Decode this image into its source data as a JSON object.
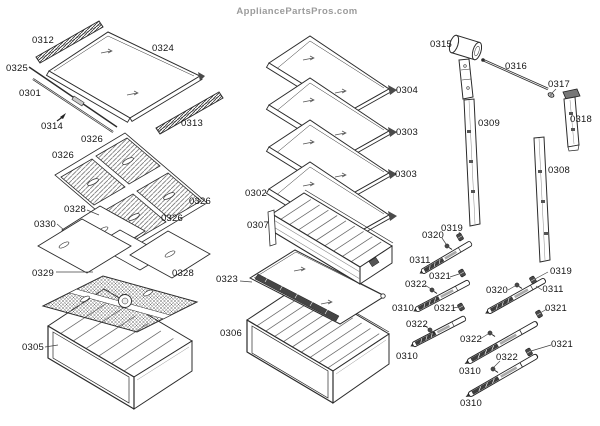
{
  "watermark": {
    "text": "AppliancePartsPros.com"
  },
  "colors": {
    "ink": "#2b2b2b",
    "label": "#141414",
    "watermark": "#9b9b9b",
    "background": "#ffffff"
  },
  "diagram": {
    "callouts": [
      {
        "part": "0312",
        "x": 43,
        "y": 43
      },
      {
        "part": "0324",
        "x": 163,
        "y": 51
      },
      {
        "part": "0325",
        "x": 17,
        "y": 71
      },
      {
        "part": "0301",
        "x": 30,
        "y": 96
      },
      {
        "part": "0314",
        "x": 52,
        "y": 129
      },
      {
        "part": "0313",
        "x": 192,
        "y": 126
      },
      {
        "part": "0326",
        "x": 92,
        "y": 142
      },
      {
        "part": "0326",
        "x": 63,
        "y": 158
      },
      {
        "part": "0326",
        "x": 200,
        "y": 204
      },
      {
        "part": "0326",
        "x": 172,
        "y": 221
      },
      {
        "part": "0328",
        "x": 75,
        "y": 212
      },
      {
        "part": "0330",
        "x": 45,
        "y": 227
      },
      {
        "part": "0329",
        "x": 43,
        "y": 276
      },
      {
        "part": "0328",
        "x": 183,
        "y": 276
      },
      {
        "part": "0305",
        "x": 33,
        "y": 350
      },
      {
        "part": "0304",
        "x": 407,
        "y": 93
      },
      {
        "part": "0303",
        "x": 407,
        "y": 135
      },
      {
        "part": "0303",
        "x": 406,
        "y": 177
      },
      {
        "part": "0302",
        "x": 256,
        "y": 196
      },
      {
        "part": "0307",
        "x": 258,
        "y": 228
      },
      {
        "part": "0323",
        "x": 227,
        "y": 282
      },
      {
        "part": "0306",
        "x": 231,
        "y": 336
      },
      {
        "part": "0315",
        "x": 441,
        "y": 47
      },
      {
        "part": "0316",
        "x": 516,
        "y": 69
      },
      {
        "part": "0317",
        "x": 559,
        "y": 87
      },
      {
        "part": "0309",
        "x": 489,
        "y": 126
      },
      {
        "part": "0318",
        "x": 581,
        "y": 122
      },
      {
        "part": "0308",
        "x": 559,
        "y": 173
      },
      {
        "part": "0319",
        "x": 452,
        "y": 231
      },
      {
        "part": "0320",
        "x": 433,
        "y": 238
      },
      {
        "part": "0311",
        "x": 420,
        "y": 263
      },
      {
        "part": "0321",
        "x": 440,
        "y": 279
      },
      {
        "part": "0322",
        "x": 416,
        "y": 287
      },
      {
        "part": "0310",
        "x": 403,
        "y": 311
      },
      {
        "part": "0321",
        "x": 445,
        "y": 311
      },
      {
        "part": "0322",
        "x": 417,
        "y": 327
      },
      {
        "part": "0310",
        "x": 407,
        "y": 359
      },
      {
        "part": "0319",
        "x": 561,
        "y": 274
      },
      {
        "part": "0311",
        "x": 553,
        "y": 292
      },
      {
        "part": "0320",
        "x": 497,
        "y": 293
      },
      {
        "part": "0321",
        "x": 556,
        "y": 311
      },
      {
        "part": "0322",
        "x": 471,
        "y": 342
      },
      {
        "part": "0321",
        "x": 562,
        "y": 347
      },
      {
        "part": "0322",
        "x": 507,
        "y": 360
      },
      {
        "part": "0310",
        "x": 470,
        "y": 374
      },
      {
        "part": "0310",
        "x": 471,
        "y": 406
      }
    ]
  }
}
